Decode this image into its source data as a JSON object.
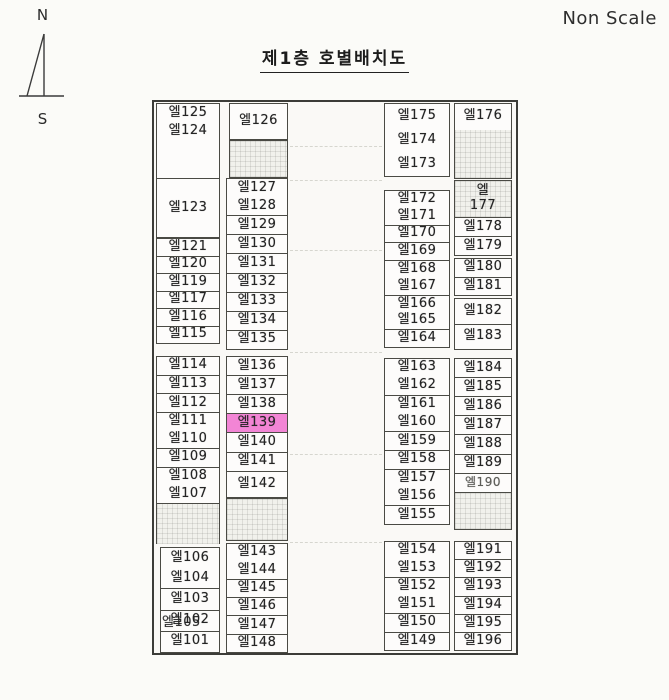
{
  "page": {
    "non_scale_label": "Non Scale",
    "title": "제1층 호별배치도",
    "compass": {
      "north_label": "N",
      "south_label": "S"
    }
  },
  "plan": {
    "highlighted_unit": "엘139",
    "highlight_color": "#f285d5",
    "blocks": {
      "c1a": [
        {
          "label": "엘125"
        },
        {
          "label": "엘124",
          "noline": true
        },
        {
          "label": "",
          "empty": true,
          "noline": true,
          "flex": 2
        },
        {
          "label": "엘123",
          "flex": 3.1
        }
      ],
      "c1b": [
        {
          "label": "엘121"
        },
        {
          "label": "엘120"
        },
        {
          "label": "엘119"
        },
        {
          "label": "엘117"
        },
        {
          "label": "엘116"
        },
        {
          "label": "엘115"
        }
      ],
      "c1c": [
        {
          "label": "엘114"
        },
        {
          "label": "엘113"
        },
        {
          "label": "엘112"
        },
        {
          "label": "엘111"
        },
        {
          "label": "엘110",
          "noline": true
        },
        {
          "label": "엘109"
        },
        {
          "label": "엘108"
        },
        {
          "label": "엘107",
          "noline": true
        }
      ],
      "c1d": [
        {
          "label": "",
          "empty": true,
          "pattern": true
        }
      ],
      "c1e": [
        {
          "label": "엘106"
        },
        {
          "label": "엘104",
          "noline": true
        },
        {
          "label": "엘103"
        },
        {
          "label": "엘102",
          "overlay": "엘105"
        },
        {
          "label": "엘101"
        }
      ],
      "c2a": [
        {
          "label": "엘126"
        }
      ],
      "c2b": [
        {
          "label": "",
          "empty": true,
          "pattern": true
        }
      ],
      "c2c": [
        {
          "label": "엘127"
        },
        {
          "label": "엘128",
          "noline": true
        },
        {
          "label": "엘129"
        },
        {
          "label": "엘130"
        },
        {
          "label": "엘131"
        },
        {
          "label": "엘132"
        },
        {
          "label": "엘133"
        },
        {
          "label": "엘134"
        },
        {
          "label": "엘135"
        }
      ],
      "c2d": [
        {
          "label": "엘136"
        },
        {
          "label": "엘137"
        },
        {
          "label": "엘138"
        },
        {
          "label": "엘139",
          "highlight": true
        },
        {
          "label": "엘140"
        },
        {
          "label": "엘141"
        },
        {
          "label": "엘142",
          "flex": 1.4
        }
      ],
      "c2e": [
        {
          "label": "",
          "empty": true,
          "pattern": true
        }
      ],
      "c2f": [
        {
          "label": "엘143"
        },
        {
          "label": "엘144",
          "noline": true
        },
        {
          "label": "엘145"
        },
        {
          "label": "엘146"
        },
        {
          "label": "엘147"
        },
        {
          "label": "엘148"
        }
      ],
      "c3a": [
        {
          "label": "엘175"
        },
        {
          "label": "엘174",
          "noline": true
        },
        {
          "label": "엘173",
          "noline": true
        }
      ],
      "c3b": [
        {
          "label": "엘172"
        },
        {
          "label": "엘171",
          "noline": true
        },
        {
          "label": "엘170"
        },
        {
          "label": "엘169"
        },
        {
          "label": "엘168"
        },
        {
          "label": "엘167",
          "noline": true
        },
        {
          "label": "엘166"
        },
        {
          "label": "엘165",
          "noline": true
        },
        {
          "label": "엘164"
        }
      ],
      "c3c": [
        {
          "label": "엘163"
        },
        {
          "label": "엘162",
          "noline": true
        },
        {
          "label": "엘161"
        },
        {
          "label": "엘160",
          "noline": true
        },
        {
          "label": "엘159"
        },
        {
          "label": "엘158"
        },
        {
          "label": "엘157"
        },
        {
          "label": "엘156",
          "noline": true
        },
        {
          "label": "엘155"
        }
      ],
      "c3d": [
        {
          "label": "엘154"
        },
        {
          "label": "엘153",
          "noline": true
        },
        {
          "label": "엘152"
        },
        {
          "label": "엘151",
          "noline": true
        },
        {
          "label": "엘150"
        },
        {
          "label": "엘149"
        }
      ],
      "c4a": [
        {
          "label": "엘176"
        },
        {
          "label": "",
          "empty": true,
          "pattern": true,
          "noline": true,
          "flex": 1.9
        }
      ],
      "c4b": [
        {
          "label": "엘\n177",
          "pattern": true,
          "flex": 2
        },
        {
          "label": "엘178"
        },
        {
          "label": "엘179"
        }
      ],
      "c4c": [
        {
          "label": "엘180"
        },
        {
          "label": "엘181"
        }
      ],
      "c4d": [
        {
          "label": "엘182"
        },
        {
          "label": "엘183"
        }
      ],
      "c4e": [
        {
          "label": "엘184"
        },
        {
          "label": "엘185"
        },
        {
          "label": "엘186"
        },
        {
          "label": "엘187"
        },
        {
          "label": "엘188"
        },
        {
          "label": "엘189"
        },
        {
          "label": "엘190",
          "faint": true
        },
        {
          "label": "",
          "empty": true,
          "pattern": true,
          "flex": 2
        }
      ],
      "c4f": [
        {
          "label": "엘191"
        },
        {
          "label": "엘192"
        },
        {
          "label": "엘193"
        },
        {
          "label": "엘194"
        },
        {
          "label": "엘195"
        },
        {
          "label": "엘196"
        }
      ]
    }
  }
}
